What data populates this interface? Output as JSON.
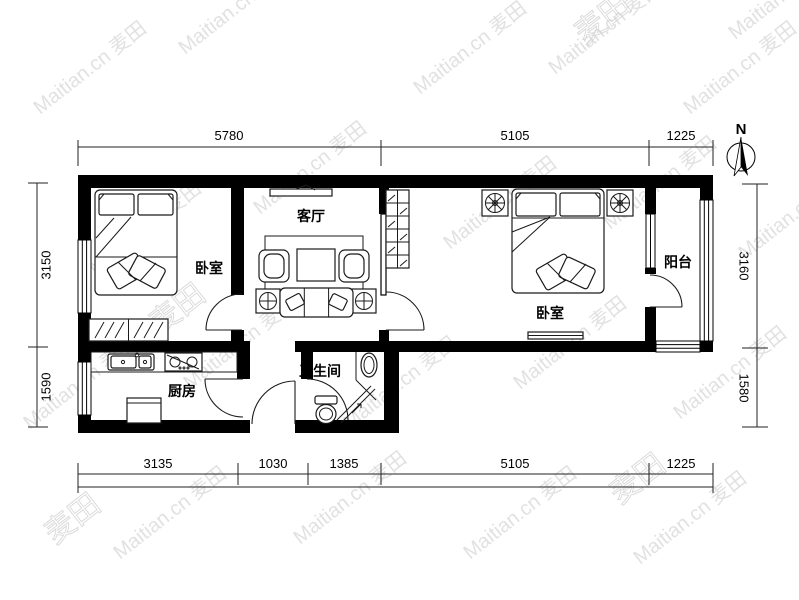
{
  "watermark": {
    "text": "Maitian.cn 麦田",
    "logo": "麦田",
    "color": "#c9c9c9"
  },
  "compass": {
    "north_label": "N"
  },
  "rooms": {
    "bedroom_left": {
      "label": "卧室"
    },
    "living_room": {
      "label": "客厅"
    },
    "bedroom_right": {
      "label": "卧室"
    },
    "balcony": {
      "label": "阳台"
    },
    "kitchen": {
      "label": "厨房"
    },
    "bathroom": {
      "label": "卫生间"
    }
  },
  "dimensions_mm": {
    "top": [
      "5780",
      "5105",
      "1225"
    ],
    "bottom": [
      "3135",
      "1030",
      "1385",
      "5105",
      "1225"
    ],
    "left": [
      "3150",
      "1590"
    ],
    "right": [
      "3160",
      "1580"
    ]
  },
  "colors": {
    "wall": "#000000",
    "background": "#ffffff",
    "watermark": "#c9c9c9"
  }
}
